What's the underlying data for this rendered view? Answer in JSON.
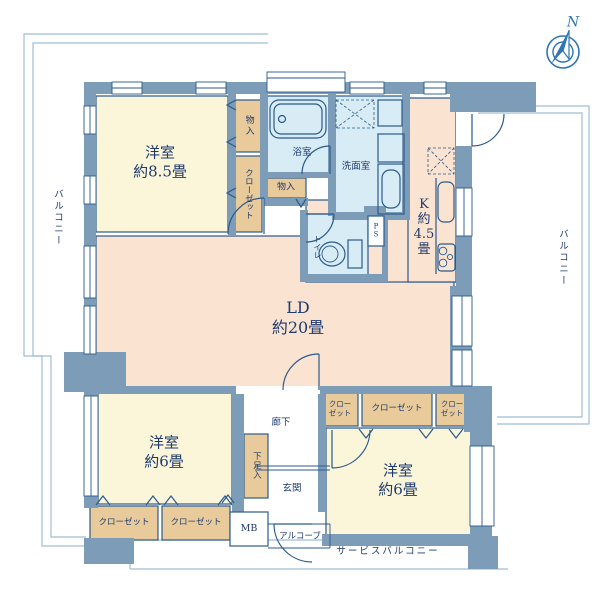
{
  "colors": {
    "wall": "#7d9cb8",
    "line": "#2a5a8c",
    "text": "#1e3a6e",
    "cream": "#fbf5da",
    "peach": "#fae3d1",
    "blue": "#d8ecf5",
    "tan": "#e9cb9b",
    "outline": "#9dbdd4",
    "paper": "#ffffff",
    "compass": "#2e75b6"
  },
  "labels": {
    "room_85": {
      "l1": "洋室",
      "l2": "約8.5畳"
    },
    "monoire_top": "物入",
    "closet_tl": "クローゼット",
    "bath": "浴室",
    "monoire_mid": "物入",
    "senmen": "洗面室",
    "kitchen": {
      "l1": "K",
      "l2": "約",
      "l3": "4.5",
      "l4": "畳"
    },
    "toilet": "トイレ",
    "ps": {
      "p": "P",
      "s": "S"
    },
    "ld": {
      "l1": "LD",
      "l2": "約20畳"
    },
    "room_6bl": {
      "l1": "洋室",
      "l2": "約6畳"
    },
    "closet_bl1": "クローゼット",
    "closet_bl2": "クローゼット",
    "shitasoku": "下足入",
    "rouka": "廊下",
    "genkan": "玄関",
    "mb": "MB",
    "alcove": "アルコーブ",
    "closet_br1": {
      "l1": "クロー",
      "l2": "ゼット"
    },
    "closet_br2": "クローゼット",
    "closet_br3": {
      "l1": "クロー",
      "l2": "ゼット"
    },
    "room_6br": {
      "l1": "洋室",
      "l2": "約6畳"
    },
    "balcony_left": "バルコニー",
    "balcony_right": "バルコニー",
    "service_balcony": "サービスバルコニー",
    "compass_n": "N"
  }
}
